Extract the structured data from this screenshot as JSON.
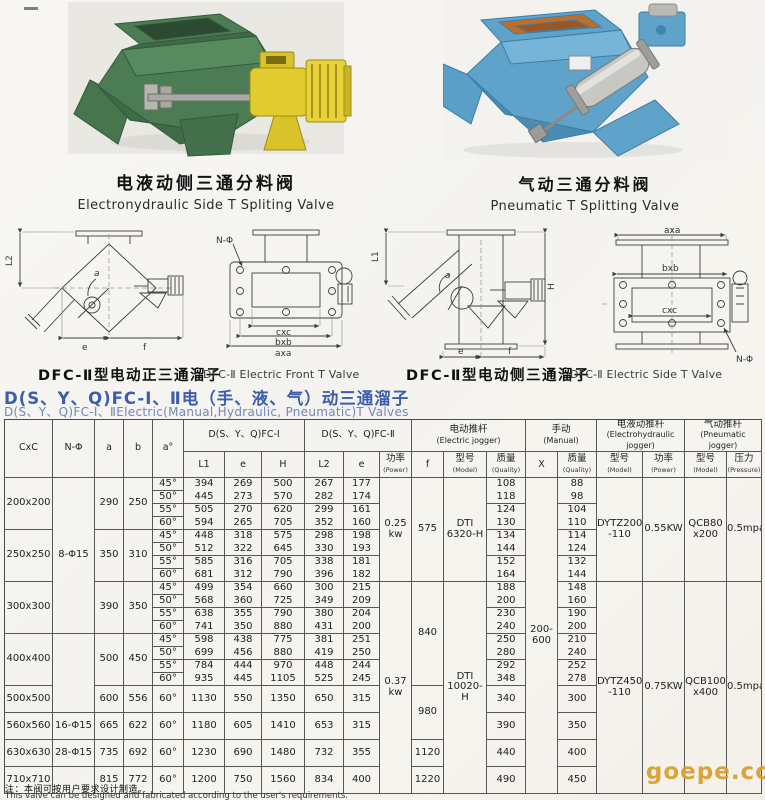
{
  "products": [
    {
      "caption_zh": "电液动侧三通分料阀",
      "caption_en": "Electronydraulic Side T Spliting Valve"
    },
    {
      "caption_zh": "气动三通分料阀",
      "caption_en": "Pneumatic T Splitting Valve"
    }
  ],
  "diagrams": {
    "front": {
      "caption_zh": "DFC-Ⅱ型电动正三通溜子",
      "caption_en": "DFC-Ⅱ Electric Front T Valve",
      "labels": {
        "l2": "L2",
        "a": "a",
        "e": "e",
        "f": "f",
        "nphi": "N-Φ",
        "cxc": "cxc",
        "bxb": "bxb",
        "axa": "axa"
      }
    },
    "side": {
      "caption_zh": "DFC-Ⅱ型电动侧三通溜子",
      "caption_en": "DFC-Ⅱ Electric Side T Valve",
      "labels": {
        "l1": "L1",
        "a": "a",
        "h": "H",
        "e": "e",
        "f": "f",
        "axa": "axa",
        "bxb": "bxb",
        "cxc": "cxc",
        "nphi": "N-Φ"
      }
    }
  },
  "heading": {
    "zh": "D(S、Y、Q)FC-Ⅰ、Ⅱ电（手、液、气）动三通溜子",
    "en": "D(S、Y、Q)FC-Ⅰ、ⅡElectric(Manual,Hydraulic, Pneumatic)T Valves"
  },
  "table": {
    "head": [
      [
        {
          "t": "CxC",
          "rs": 2,
          "n": "col-cxc"
        },
        {
          "t": "N-Φ",
          "rs": 2,
          "n": "col-nphi"
        },
        {
          "t": "a",
          "rs": 2,
          "n": "col-a"
        },
        {
          "t": "b",
          "rs": 2,
          "n": "col-b"
        },
        {
          "t": "a°",
          "rs": 2,
          "n": "col-angle"
        },
        {
          "t": "D(S、Y、Q)FC-Ⅰ",
          "cs": 3,
          "n": "group-fc1"
        },
        {
          "t": "D(S、Y、Q)FC-Ⅱ",
          "cs": 3,
          "n": "group-fc2"
        },
        {
          "t": "电动推杆",
          "t2": "(Electric jogger)",
          "cs": 3,
          "n": "group-electric-jogger"
        },
        {
          "t": "手动",
          "t2": "(Manual)",
          "cs": 2,
          "n": "group-manual"
        },
        {
          "t": "电液动推杆",
          "t2": "(Electrohydraulic jogger)",
          "cs": 2,
          "n": "group-electrohydraulic-jogger"
        },
        {
          "t": "气动推杆",
          "t2": "(Pneumatic jogger)",
          "cs": 2,
          "n": "group-pneumatic-jogger"
        }
      ],
      [
        {
          "t": "L1",
          "n": "col-l1"
        },
        {
          "t": "e",
          "n": "col-e1"
        },
        {
          "t": "H",
          "n": "col-h"
        },
        {
          "t": "L2",
          "n": "col-l2"
        },
        {
          "t": "e",
          "n": "col-e2"
        },
        {
          "t": "功率",
          "t2": "(Power)",
          "n": "col-power"
        },
        {
          "t": "f",
          "n": "col-f"
        },
        {
          "t": "型号",
          "t2": "(Model)",
          "n": "col-electric-model"
        },
        {
          "t": "质量",
          "t2": "(Quality)",
          "n": "col-electric-quality"
        },
        {
          "t": "X",
          "n": "col-x"
        },
        {
          "t": "质量",
          "t2": "(Quality)",
          "n": "col-manual-quality"
        },
        {
          "t": "型号",
          "t2": "(Model)",
          "n": "col-eh-model"
        },
        {
          "t": "功率",
          "t2": "(Power)",
          "n": "col-eh-power"
        },
        {
          "t": "型号",
          "t2": "(Model)",
          "n": "col-pneu-model"
        },
        {
          "t": "压力",
          "t2": "(Pressure)",
          "n": "col-pneu-pressure"
        }
      ]
    ],
    "body": [
      {
        "cells": [
          {
            "t": "200x200",
            "rs": 4,
            "n": "size-cell"
          },
          {
            "t": "8-Φ15",
            "rs": 12,
            "n": "nphi-cell"
          },
          {
            "t": "290",
            "rs": 4
          },
          {
            "t": "250",
            "rs": 4
          },
          {
            "t": "45°"
          },
          {
            "t": "394",
            "cls": "nb"
          },
          {
            "t": "269",
            "cls": "nb"
          },
          {
            "t": "500",
            "cls": "nb"
          },
          {
            "t": "267",
            "cls": "nb"
          },
          {
            "t": "177",
            "cls": "nb"
          },
          {
            "t": "0.25\nkw",
            "rs": 8,
            "n": "power-cell"
          },
          {
            "t": "575",
            "rs": 8,
            "n": "f-cell"
          },
          {
            "t": "DTⅠ\n6320-H",
            "rs": 8,
            "n": "electric-model-cell"
          },
          {
            "t": "108",
            "cls": "nb"
          },
          {
            "t": "200-\n600",
            "rs": 20,
            "n": "x-cell"
          },
          {
            "t": "88",
            "cls": "nb"
          },
          {
            "t": "DYTZ200\n-110",
            "rs": 8,
            "n": "eh-model-cell"
          },
          {
            "t": "0.55KW",
            "rs": 8,
            "n": "eh-power-cell"
          },
          {
            "t": "QCB80\nx200",
            "rs": 8,
            "n": "pneu-model-cell"
          },
          {
            "t": "0.5mpa",
            "rs": 8,
            "n": "pneu-pressure-cell"
          }
        ]
      },
      {
        "cells": [
          {
            "t": "50°"
          },
          {
            "t": "445"
          },
          {
            "t": "273"
          },
          {
            "t": "570"
          },
          {
            "t": "282"
          },
          {
            "t": "174"
          },
          {
            "t": "118"
          },
          {
            "t": "98"
          }
        ]
      },
      {
        "cells": [
          {
            "t": "55°"
          },
          {
            "t": "505",
            "cls": "nb"
          },
          {
            "t": "270",
            "cls": "nb"
          },
          {
            "t": "620",
            "cls": "nb"
          },
          {
            "t": "299",
            "cls": "nb"
          },
          {
            "t": "161",
            "cls": "nb"
          },
          {
            "t": "124",
            "cls": "nb"
          },
          {
            "t": "104",
            "cls": "nb"
          }
        ]
      },
      {
        "cells": [
          {
            "t": "60°"
          },
          {
            "t": "594"
          },
          {
            "t": "265"
          },
          {
            "t": "705"
          },
          {
            "t": "352"
          },
          {
            "t": "160"
          },
          {
            "t": "130"
          },
          {
            "t": "110"
          }
        ]
      },
      {
        "cells": [
          {
            "t": "250x250",
            "rs": 4,
            "n": "size-cell"
          },
          {
            "t": "350",
            "rs": 4
          },
          {
            "t": "310",
            "rs": 4
          },
          {
            "t": "45°"
          },
          {
            "t": "448",
            "cls": "nb"
          },
          {
            "t": "318",
            "cls": "nb"
          },
          {
            "t": "575",
            "cls": "nb"
          },
          {
            "t": "298",
            "cls": "nb"
          },
          {
            "t": "198",
            "cls": "nb"
          },
          {
            "t": "134",
            "cls": "nb"
          },
          {
            "t": "114",
            "cls": "nb"
          }
        ]
      },
      {
        "cells": [
          {
            "t": "50°"
          },
          {
            "t": "512"
          },
          {
            "t": "322"
          },
          {
            "t": "645"
          },
          {
            "t": "330"
          },
          {
            "t": "193"
          },
          {
            "t": "144"
          },
          {
            "t": "124"
          }
        ]
      },
      {
        "cells": [
          {
            "t": "55°"
          },
          {
            "t": "585",
            "cls": "nb"
          },
          {
            "t": "316",
            "cls": "nb"
          },
          {
            "t": "705",
            "cls": "nb"
          },
          {
            "t": "338",
            "cls": "nb"
          },
          {
            "t": "181",
            "cls": "nb"
          },
          {
            "t": "152",
            "cls": "nb"
          },
          {
            "t": "132",
            "cls": "nb"
          }
        ]
      },
      {
        "cells": [
          {
            "t": "60°"
          },
          {
            "t": "681"
          },
          {
            "t": "312"
          },
          {
            "t": "790"
          },
          {
            "t": "396"
          },
          {
            "t": "182"
          },
          {
            "t": "164"
          },
          {
            "t": "144"
          }
        ]
      },
      {
        "cells": [
          {
            "t": "300x300",
            "rs": 4,
            "n": "size-cell"
          },
          {
            "t": "390",
            "rs": 4
          },
          {
            "t": "350",
            "rs": 4
          },
          {
            "t": "45°"
          },
          {
            "t": "499",
            "cls": "nb"
          },
          {
            "t": "354",
            "cls": "nb"
          },
          {
            "t": "660",
            "cls": "nb"
          },
          {
            "t": "300",
            "cls": "nb"
          },
          {
            "t": "215",
            "cls": "nb"
          },
          {
            "t": "0.37\nkw",
            "rs": 12,
            "n": "power-cell"
          },
          {
            "t": "840",
            "rs": 8,
            "n": "f-cell"
          },
          {
            "t": "DTⅠ\n10020-H",
            "rs": 12,
            "n": "electric-model-cell"
          },
          {
            "t": "188",
            "cls": "nb"
          },
          {
            "t": "148",
            "cls": "nb"
          },
          {
            "t": "DYTZ450\n-110",
            "rs": 12,
            "n": "eh-model-cell"
          },
          {
            "t": "0.75KW",
            "rs": 12,
            "n": "eh-power-cell"
          },
          {
            "t": "QCB100\nx400",
            "rs": 12,
            "n": "pneu-model-cell"
          },
          {
            "t": "0.5mpa",
            "rs": 12,
            "n": "pneu-pressure-cell"
          }
        ]
      },
      {
        "cells": [
          {
            "t": "50°"
          },
          {
            "t": "568"
          },
          {
            "t": "360"
          },
          {
            "t": "725"
          },
          {
            "t": "349"
          },
          {
            "t": "209"
          },
          {
            "t": "200"
          },
          {
            "t": "160"
          }
        ]
      },
      {
        "cells": [
          {
            "t": "55°"
          },
          {
            "t": "638",
            "cls": "nb"
          },
          {
            "t": "355",
            "cls": "nb"
          },
          {
            "t": "790",
            "cls": "nb"
          },
          {
            "t": "380",
            "cls": "nb"
          },
          {
            "t": "204",
            "cls": "nb"
          },
          {
            "t": "230",
            "cls": "nb"
          },
          {
            "t": "190",
            "cls": "nb"
          }
        ]
      },
      {
        "cells": [
          {
            "t": "60°"
          },
          {
            "t": "741"
          },
          {
            "t": "350"
          },
          {
            "t": "880"
          },
          {
            "t": "431"
          },
          {
            "t": "200"
          },
          {
            "t": "240"
          },
          {
            "t": "200"
          }
        ]
      },
      {
        "cells": [
          {
            "t": "400x400",
            "rs": 4,
            "n": "size-cell"
          },
          {
            "t": "",
            "rs": 5,
            "n": "nphi-cell"
          },
          {
            "t": "500",
            "rs": 4
          },
          {
            "t": "450",
            "rs": 4
          },
          {
            "t": "45°"
          },
          {
            "t": "598",
            "cls": "nb"
          },
          {
            "t": "438",
            "cls": "nb"
          },
          {
            "t": "775",
            "cls": "nb"
          },
          {
            "t": "381",
            "cls": "nb"
          },
          {
            "t": "251",
            "cls": "nb"
          },
          {
            "t": "250",
            "cls": "nb"
          },
          {
            "t": "210",
            "cls": "nb"
          }
        ]
      },
      {
        "cells": [
          {
            "t": "50°"
          },
          {
            "t": "699"
          },
          {
            "t": "456"
          },
          {
            "t": "880"
          },
          {
            "t": "419"
          },
          {
            "t": "250"
          },
          {
            "t": "280"
          },
          {
            "t": "240"
          }
        ]
      },
      {
        "cells": [
          {
            "t": "55°"
          },
          {
            "t": "784",
            "cls": "nb"
          },
          {
            "t": "444",
            "cls": "nb"
          },
          {
            "t": "970",
            "cls": "nb"
          },
          {
            "t": "448",
            "cls": "nb"
          },
          {
            "t": "244",
            "cls": "nb"
          },
          {
            "t": "292",
            "cls": "nb"
          },
          {
            "t": "252",
            "cls": "nb"
          }
        ]
      },
      {
        "cells": [
          {
            "t": "60°"
          },
          {
            "t": "935"
          },
          {
            "t": "445"
          },
          {
            "t": "1105"
          },
          {
            "t": "525"
          },
          {
            "t": "245"
          },
          {
            "t": "348"
          },
          {
            "t": "278"
          }
        ]
      },
      {
        "tall": true,
        "cells": [
          {
            "t": "500x500",
            "n": "size-cell"
          },
          {
            "t": "600"
          },
          {
            "t": "556"
          },
          {
            "t": "60°"
          },
          {
            "t": "1130"
          },
          {
            "t": "550"
          },
          {
            "t": "1350"
          },
          {
            "t": "650"
          },
          {
            "t": "315"
          },
          {
            "t": "980",
            "rs": 2,
            "n": "f-cell"
          },
          {
            "t": "340"
          },
          {
            "t": "300"
          }
        ]
      },
      {
        "tall": true,
        "cells": [
          {
            "t": "560x560",
            "n": "size-cell"
          },
          {
            "t": "16-Φ15",
            "n": "nphi-cell"
          },
          {
            "t": "665"
          },
          {
            "t": "622"
          },
          {
            "t": "60°"
          },
          {
            "t": "1180"
          },
          {
            "t": "605"
          },
          {
            "t": "1410"
          },
          {
            "t": "653"
          },
          {
            "t": "315"
          },
          {
            "t": "390"
          },
          {
            "t": "350"
          }
        ]
      },
      {
        "tall": true,
        "cells": [
          {
            "t": "630x630",
            "n": "size-cell"
          },
          {
            "t": "28-Φ15",
            "n": "nphi-cell"
          },
          {
            "t": "735"
          },
          {
            "t": "692"
          },
          {
            "t": "60°"
          },
          {
            "t": "1230"
          },
          {
            "t": "690"
          },
          {
            "t": "1480"
          },
          {
            "t": "732"
          },
          {
            "t": "355"
          },
          {
            "t": "1120",
            "n": "f-cell"
          },
          {
            "t": "440"
          },
          {
            "t": "400"
          }
        ]
      },
      {
        "tall": true,
        "cells": [
          {
            "t": "710x710",
            "n": "size-cell"
          },
          {
            "t": "",
            "n": "nphi-cell"
          },
          {
            "t": "815"
          },
          {
            "t": "772"
          },
          {
            "t": "60°"
          },
          {
            "t": "1200"
          },
          {
            "t": "750"
          },
          {
            "t": "1560"
          },
          {
            "t": "834"
          },
          {
            "t": "400"
          },
          {
            "t": "1220",
            "n": "f-cell"
          },
          {
            "t": "490"
          },
          {
            "t": "450"
          }
        ]
      }
    ]
  },
  "notes": {
    "zh": "注：本阀可按用户要求设计制造。",
    "en": "This valve can be designed and fabricated according to the user's requirements."
  },
  "watermark": "goepe.co"
}
